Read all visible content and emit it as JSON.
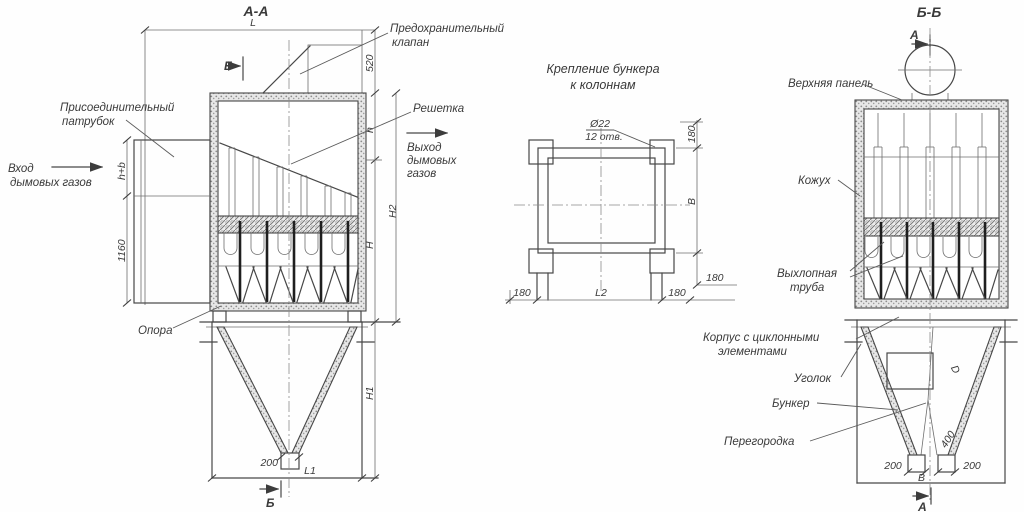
{
  "colors": {
    "line": "#474747",
    "thin_line": "#6e6e6e",
    "text": "#3a3a3a",
    "background": "#fefefe",
    "wall_fill": "#d9d9d9"
  },
  "views": {
    "section_aa": {
      "title": "А-А",
      "section_marker": "Б",
      "labels": {
        "connecting_pipe_1": "Присоединительный",
        "connecting_pipe_2": "патрубок",
        "safety_valve_1": "Предохранительный",
        "safety_valve_2": "клапан",
        "inlet_1": "Вход",
        "inlet_2": "дымовых газов",
        "grate": "Решетка",
        "outlet_1": "Выход",
        "outlet_2": "дымовых",
        "outlet_3": "газов",
        "support": "Опора"
      },
      "dims": {
        "L": "L",
        "d520": "520",
        "h_plus_b": "h+b",
        "d1160": "1160",
        "h": "h",
        "H2": "Н2",
        "H": "Н",
        "H1": "Н1",
        "d200": "200",
        "L1": "L1"
      }
    },
    "bunker_mount": {
      "title_1": "Крепление бункера",
      "title_2": "к колоннам",
      "holes_note_1": "Ø22",
      "holes_note_2": "12 отв.",
      "dims": {
        "top_180": "180",
        "B": "В",
        "right_180": "180",
        "left_180": "180",
        "L2": "L2",
        "bottom_180": "180"
      }
    },
    "section_bb": {
      "title": "Б-Б",
      "section_marker": "А",
      "labels": {
        "top_panel": "Верхняя панель",
        "casing": "Кожух",
        "exhaust_pipe_1": "Выхлопная",
        "exhaust_pipe_2": "труба",
        "body_1": "Корпус с циклонными",
        "body_2": "элементами",
        "angle": "Уголок",
        "bunker": "Бункер",
        "partition": "Перегородка"
      },
      "dims": {
        "D": "D",
        "d400": "400",
        "d200_left": "200",
        "d200_right": "200",
        "B": "В"
      }
    }
  }
}
